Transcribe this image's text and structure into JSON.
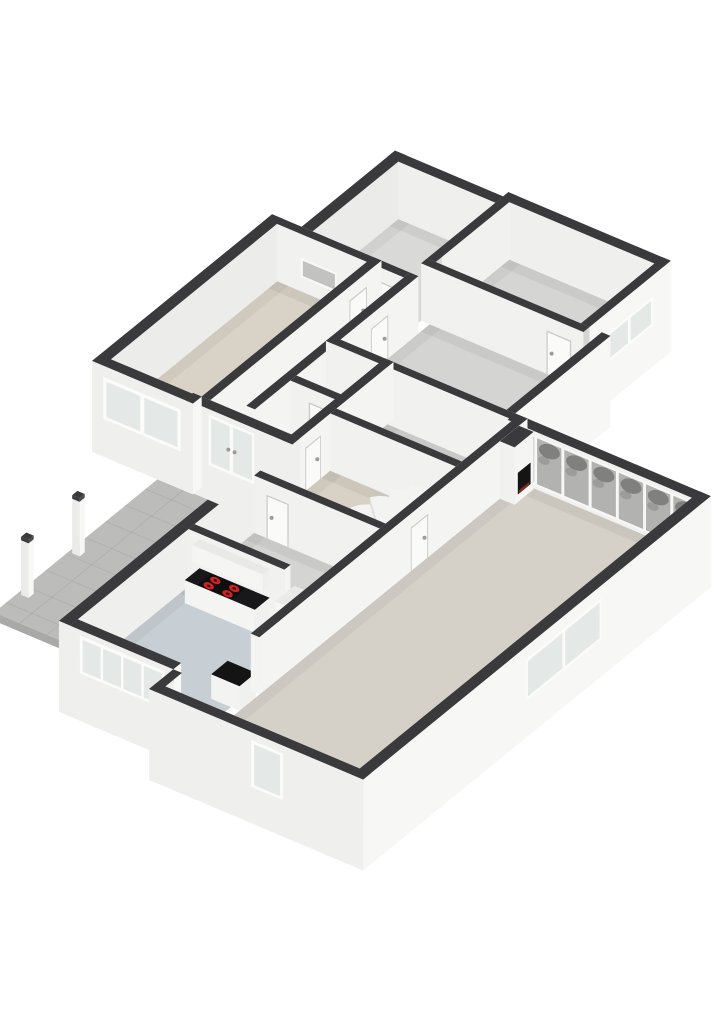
{
  "canvas": {
    "width": 724,
    "height": 1024
  },
  "scene": {
    "kind": "3d-floorplan-render",
    "view": "isometric-from-south-east",
    "background": "#ffffff"
  },
  "palette": {
    "background": "#ffffff",
    "wall_cap": "#3a3a3c",
    "wall_exterior_se": "#f7f7f6",
    "wall_exterior_sw": "#efefee",
    "wall_interior_se": "#f4f4f2",
    "wall_interior_sw": "#f1f1ef",
    "wall_inner_shaded": "#ececea",
    "floor_gray": "#d4d4d2",
    "floor_bedroom": "#d9d9d7",
    "floor_bedroom_right": "#d5d5d3",
    "floor_beige": "#d9d2c6",
    "floor_carpet": "#d8d1c5",
    "floor_kitchen": "#c7ced4",
    "floor_living": "#d5d1c9",
    "terrace": "#bcbcba",
    "counter_top": "#18181a",
    "stove_top": "#0f0f10",
    "burner_red": "#d42020",
    "glass_exterior": "#e4e8e7",
    "glass_band": "#b2b2b0",
    "foliage": "#4e4e4c",
    "stair_tread": "#f3f3f2",
    "stair_riser": "#e0e0de",
    "niche_dark": "#151516",
    "ember": "#7c2a20",
    "door_leaf": "#fafaf9",
    "door_frame": "#c9c9c7"
  },
  "rooms": [
    {
      "name": "living-room",
      "floor": "floor_living"
    },
    {
      "name": "kitchen",
      "floor": "floor_kitchen"
    },
    {
      "name": "hall",
      "floor": "floor_gray"
    },
    {
      "name": "corridor",
      "floor": "floor_gray"
    },
    {
      "name": "entry",
      "floor": "floor_gray"
    },
    {
      "name": "wc",
      "floor": "floor_gray"
    },
    {
      "name": "stair-room",
      "floor": "floor_carpet"
    },
    {
      "name": "storage",
      "floor": "floor_gray"
    },
    {
      "name": "back-hall",
      "floor": "floor_gray"
    },
    {
      "name": "bedroom-left",
      "floor": "floor_beige"
    },
    {
      "name": "bedroom-top",
      "floor": "floor_bedroom"
    },
    {
      "name": "bedroom-right",
      "floor": "floor_bedroom_right"
    },
    {
      "name": "terrace",
      "floor": "terrace"
    }
  ],
  "fixtures": {
    "stove_burners": 4,
    "sink": 1,
    "tall_cabinet_with_oven": 1,
    "kitchen_island": 1,
    "fireplace_niche": 1,
    "winder_stair_steps": 6,
    "fence_posts": 2,
    "french_door_leaves": 2,
    "window_band_panes": 7,
    "kitchen_window_panes": 4,
    "interior_pass_window": 1
  }
}
